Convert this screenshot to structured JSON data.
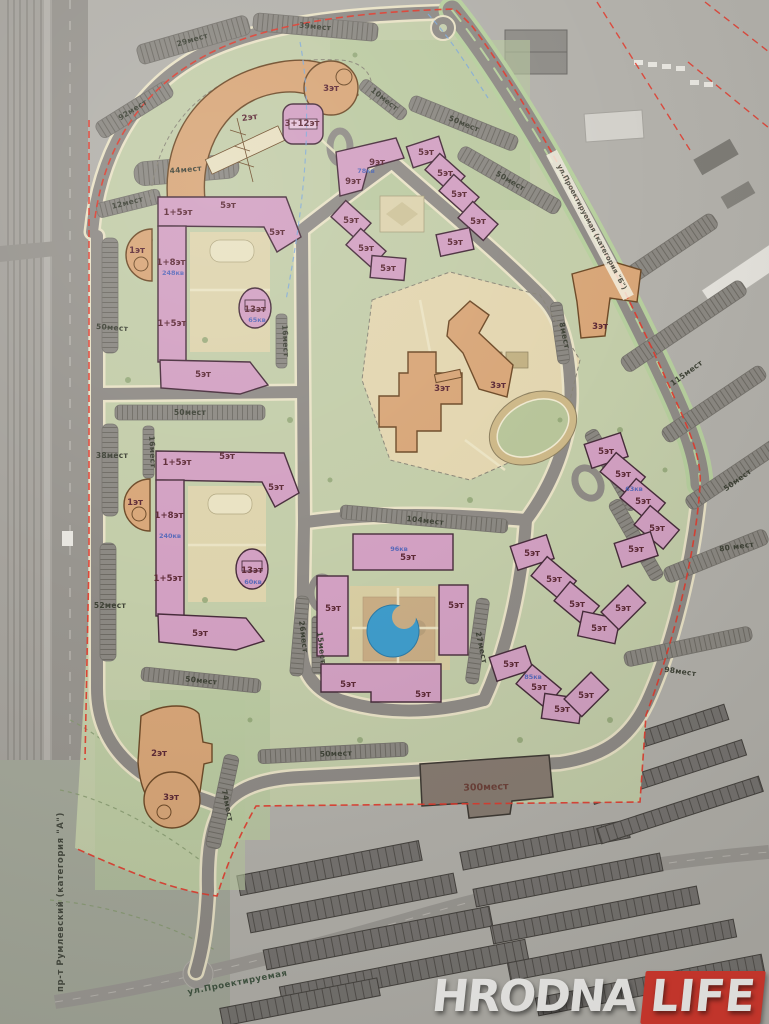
{
  "watermark": {
    "word1": "HRODNA",
    "word2": "LIFE",
    "accent_color": "#d6372c"
  },
  "streets": {
    "prospekt": "пр-т Румлевский (категория \"А\")",
    "bottom_street": "ул.Проектируемая",
    "top_right_street": "ул.Проектируемая (категория \"Б\")"
  },
  "labels": {
    "floors": [
      "2эт",
      "3эт",
      "3+12эт",
      "9эт",
      "9эт",
      "5эт",
      "5эт",
      "5эт",
      "5эт",
      "5эт",
      "5эт",
      "5эт",
      "5эт",
      "1+5эт",
      "5эт",
      "5эт",
      "1эт",
      "1+8эт",
      "1+5эт",
      "5эт",
      "13эт",
      "3эт",
      "3эт",
      "3эт",
      "1+5эт",
      "5эт",
      "5эт",
      "1эт",
      "1+8эт",
      "1+5эт",
      "5эт",
      "13эт",
      "5эт",
      "5эт",
      "5эт",
      "5эт",
      "5эт",
      "5эт",
      "5эт",
      "5эт",
      "5эт",
      "5эт",
      "5эт",
      "5эт",
      "5эт",
      "5эт",
      "5эт",
      "5эт",
      "5эт",
      "5эт",
      "5эт",
      "2эт",
      "3эт"
    ],
    "parking": [
      "29мест",
      "39мест",
      "10мест",
      "50мест",
      "50мест",
      "92мест",
      "44мест",
      "12мест",
      "50мест",
      "50мест",
      "38мест",
      "52мест",
      "50мест",
      "74мест",
      "26мест",
      "16мест",
      "16мест",
      "104мест",
      "27мест",
      "15мест",
      "50мест",
      "98мест",
      "115мест",
      "50мест",
      "80 мест",
      "8мест"
    ],
    "apartments": [
      "248кв",
      "240кв",
      "65кв",
      "60кв",
      "78кв",
      "96кв",
      "85кв",
      "63кв"
    ],
    "garage": "300мест"
  },
  "map_colors": {
    "residential_building": "#d2a0c2",
    "public_building": "#d8a678",
    "garage_building": "#877b71",
    "district_green": "#c3cda9",
    "pond_blue": "#3e9ccb",
    "boundary_red": "#e2392b"
  }
}
